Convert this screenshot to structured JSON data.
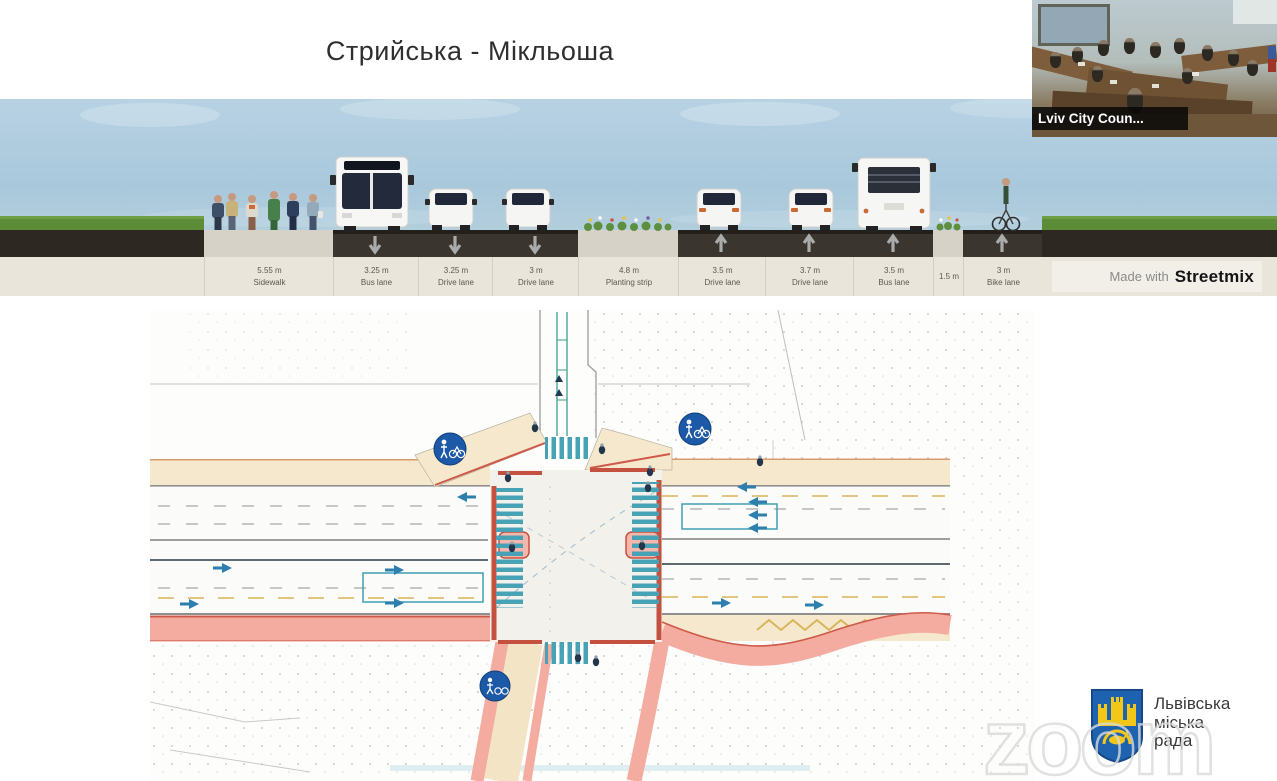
{
  "slide": {
    "title": "Стрийська - Мікльоша"
  },
  "streetmix": {
    "credit_prefix": "Made with",
    "credit_brand": "Streetmix",
    "segments": [
      {
        "width": "5.55 m",
        "label": "Sidewalk"
      },
      {
        "width": "3.25 m",
        "label": "Bus lane"
      },
      {
        "width": "3.25 m",
        "label": "Drive lane"
      },
      {
        "width": "3 m",
        "label": "Drive lane"
      },
      {
        "width": "4.8 m",
        "label": "Planting strip"
      },
      {
        "width": "3.5 m",
        "label": "Drive lane"
      },
      {
        "width": "3.7 m",
        "label": "Drive lane"
      },
      {
        "width": "3.5 m",
        "label": "Bus lane"
      },
      {
        "width": "1.5 m",
        "label": ""
      },
      {
        "width": "3 m",
        "label": "Bike lane"
      }
    ]
  },
  "map": {
    "type": "intersection-plan",
    "signs": [
      {
        "name": "shared-pedestrian-bicycle-sign"
      },
      {
        "name": "shared-pedestrian-bicycle-sign"
      },
      {
        "name": "shared-pedestrian-bicycle-sign"
      }
    ]
  },
  "video_thumbnail": {
    "participant_name": "Lviv City Coun..."
  },
  "watermark": {
    "text": "zoom"
  },
  "logo": {
    "line1": "Львівська",
    "line2": "міська",
    "line3": "рада"
  },
  "colors": {
    "sign_blue": "#1c59a6",
    "crosswalk_teal": "#48a2b6",
    "curb_red": "#c4503f",
    "sidewalk_salmon": "#f4aca0",
    "road_beige": "#f5e8cd",
    "sky": "#a9c8dc",
    "asphalt": "#3a352f",
    "grass": "#5c8c38"
  }
}
